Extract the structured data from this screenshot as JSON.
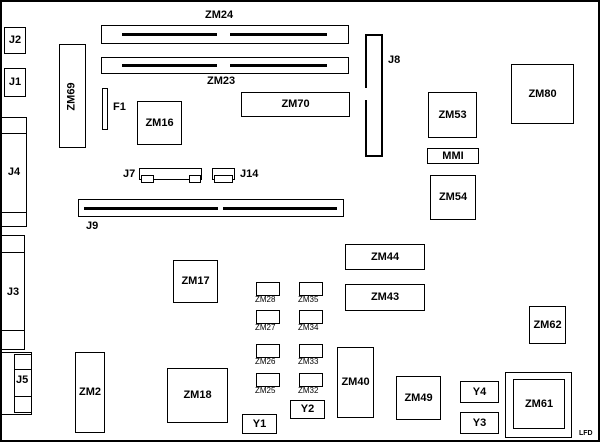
{
  "labels": {
    "j1": "J1",
    "j2": "J2",
    "j3": "J3",
    "j4": "J4",
    "j5": "J5",
    "j7": "J7",
    "j8": "J8",
    "j9": "J9",
    "j14": "J14",
    "f1": "F1",
    "mmi": "MMI",
    "zm2": "ZM2",
    "zm16": "ZM16",
    "zm17": "ZM17",
    "zm18": "ZM18",
    "zm23": "ZM23",
    "zm24": "ZM24",
    "zm25": "ZM25",
    "zm26": "ZM26",
    "zm27": "ZM27",
    "zm28": "ZM28",
    "zm32": "ZM32",
    "zm33": "ZM33",
    "zm34": "ZM34",
    "zm35": "ZM35",
    "zm40": "ZM40",
    "zm43": "ZM43",
    "zm44": "ZM44",
    "zm49": "ZM49",
    "zm53": "ZM53",
    "zm54": "ZM54",
    "zm61": "ZM61",
    "zm62": "ZM62",
    "zm69": "ZM69",
    "zm70": "ZM70",
    "zm80": "ZM80",
    "y1": "Y1",
    "y2": "Y2",
    "y3": "Y3",
    "y4": "Y4",
    "corner_mark": "LFD"
  },
  "colors": {
    "line": "#000000",
    "background": "#ffffff"
  }
}
